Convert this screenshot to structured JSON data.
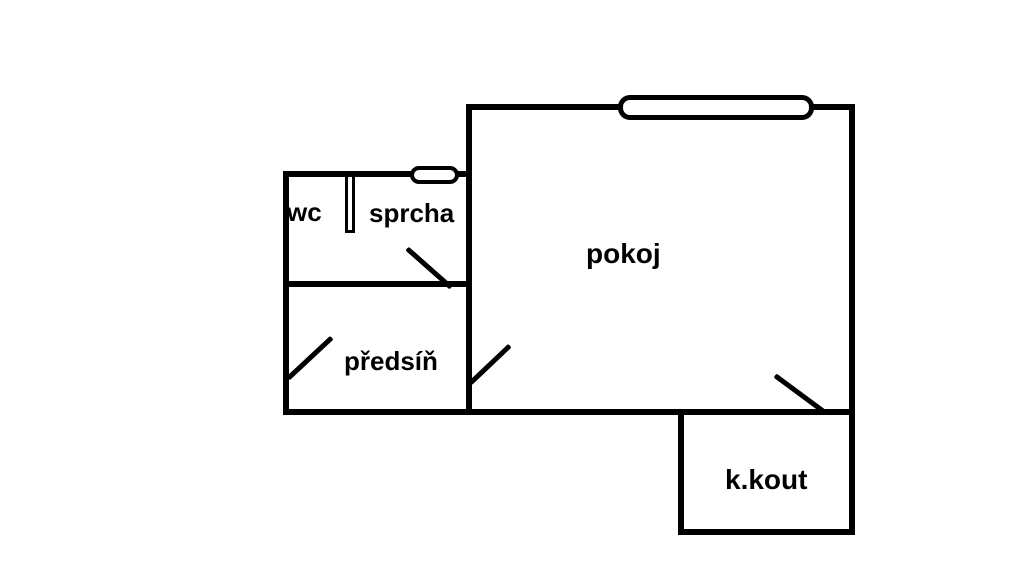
{
  "floorplan": {
    "background_color": "#ffffff",
    "wall_color": "#000000",
    "text_color": "#000000",
    "rooms": [
      {
        "id": "wc",
        "label": "wc"
      },
      {
        "id": "sprcha",
        "label": "sprcha"
      },
      {
        "id": "pokoj",
        "label": "pokoj"
      },
      {
        "id": "predsin",
        "label": "předsíň"
      },
      {
        "id": "k-kout",
        "label": "k.kout"
      }
    ],
    "features": {
      "windows": [
        "pokoj-top-window",
        "sprcha-top-window"
      ],
      "doors": [
        "sprcha-door-swing",
        "predsin-entry-door-swing",
        "pokoj-predsin-door-swing",
        "pokoj-kkout-door-swing"
      ],
      "partitions": [
        "wc-sprcha-partition"
      ]
    }
  }
}
